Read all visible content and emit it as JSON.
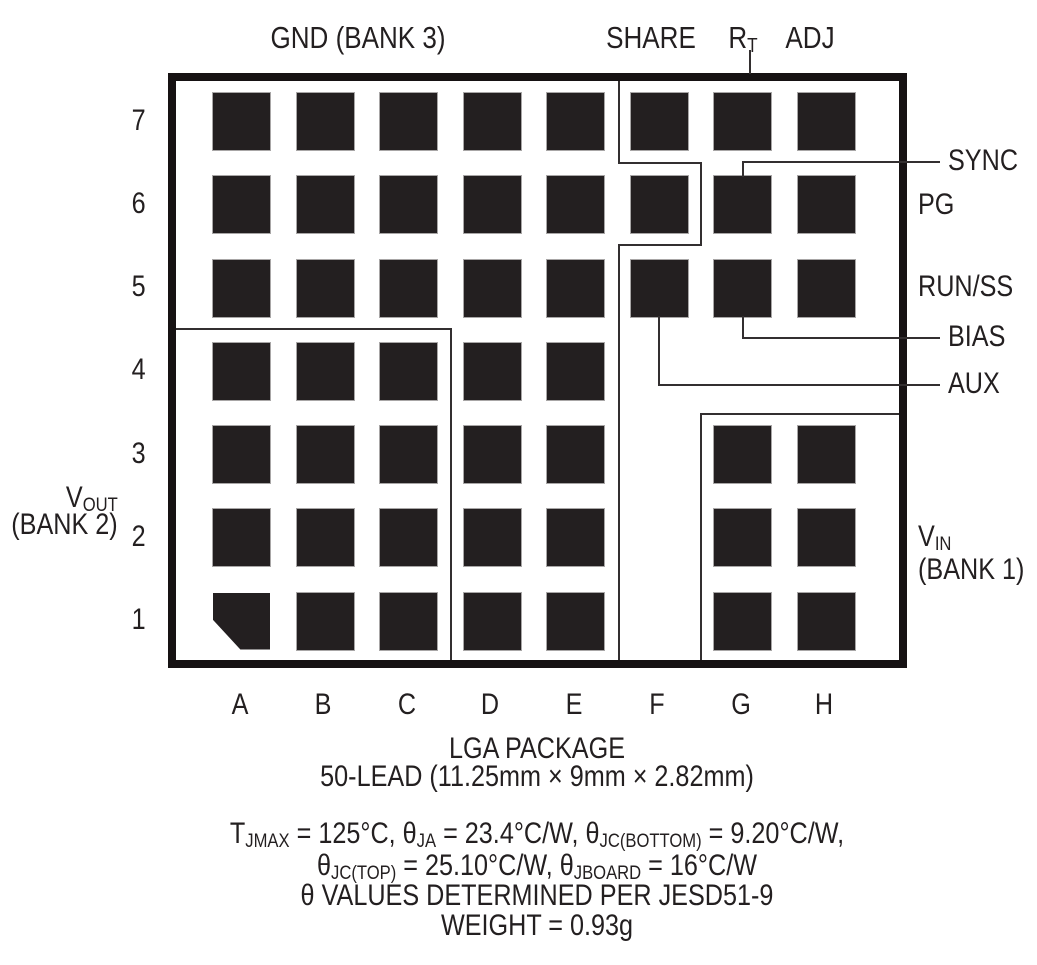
{
  "figure": {
    "top_labels": {
      "gnd_bank3": "GND (BANK 3)",
      "share": "SHARE",
      "rt": [
        {
          "t": "R"
        },
        {
          "t": "T",
          "sub": true
        }
      ],
      "adj": "ADJ"
    },
    "right_labels": {
      "sync": "SYNC",
      "pg": "PG",
      "run_ss": "RUN/SS",
      "bias": "BIAS",
      "aux": "AUX",
      "vin": [
        {
          "t": "V"
        },
        {
          "t": "IN",
          "sub": true
        }
      ],
      "vin_bank": "(BANK 1)"
    },
    "left_labels": {
      "vout": [
        {
          "t": "V"
        },
        {
          "t": "OUT",
          "sub": true
        }
      ],
      "vout_bank": "(BANK 2)"
    },
    "row_labels": [
      "7",
      "6",
      "5",
      "4",
      "3",
      "2",
      "1"
    ],
    "col_labels": [
      "A",
      "B",
      "C",
      "D",
      "E",
      "F",
      "G",
      "H"
    ],
    "pads": {
      "columns": [
        "A",
        "B",
        "C",
        "D",
        "E",
        "F",
        "G",
        "H"
      ],
      "rows": [
        7,
        6,
        5,
        4,
        3,
        2,
        1
      ],
      "missing": [
        "F4",
        "G4",
        "H4",
        "F3",
        "F2",
        "F1"
      ],
      "pin1_chamfer": "A1",
      "total_leads": 50
    }
  },
  "caption": {
    "line1": "LGA PACKAGE",
    "line2": "50-LEAD (11.25mm × 9mm × 2.82mm)"
  },
  "notes": {
    "thermal1": [
      {
        "t": "T"
      },
      {
        "t": "JMAX",
        "sub": true
      },
      {
        "t": " = 125°C, θ"
      },
      {
        "t": "JA",
        "sub": true
      },
      {
        "t": " = 23.4°C/W, θ"
      },
      {
        "t": "JC(BOTTOM)",
        "sub": true
      },
      {
        "t": " = 9.20°C/W,"
      }
    ],
    "thermal2": [
      {
        "t": "θ"
      },
      {
        "t": "JC(TOP)",
        "sub": true
      },
      {
        "t": " = 25.10°C/W, θ"
      },
      {
        "t": "JBOARD",
        "sub": true
      },
      {
        "t": " = 16°C/W"
      }
    ],
    "jesd": "θ VALUES DETERMINED PER JESD51-9",
    "weight": "WEIGHT = 0.93g"
  },
  "colors": {
    "ink": "#231f20",
    "pad": "#231f20",
    "background": "#ffffff"
  }
}
